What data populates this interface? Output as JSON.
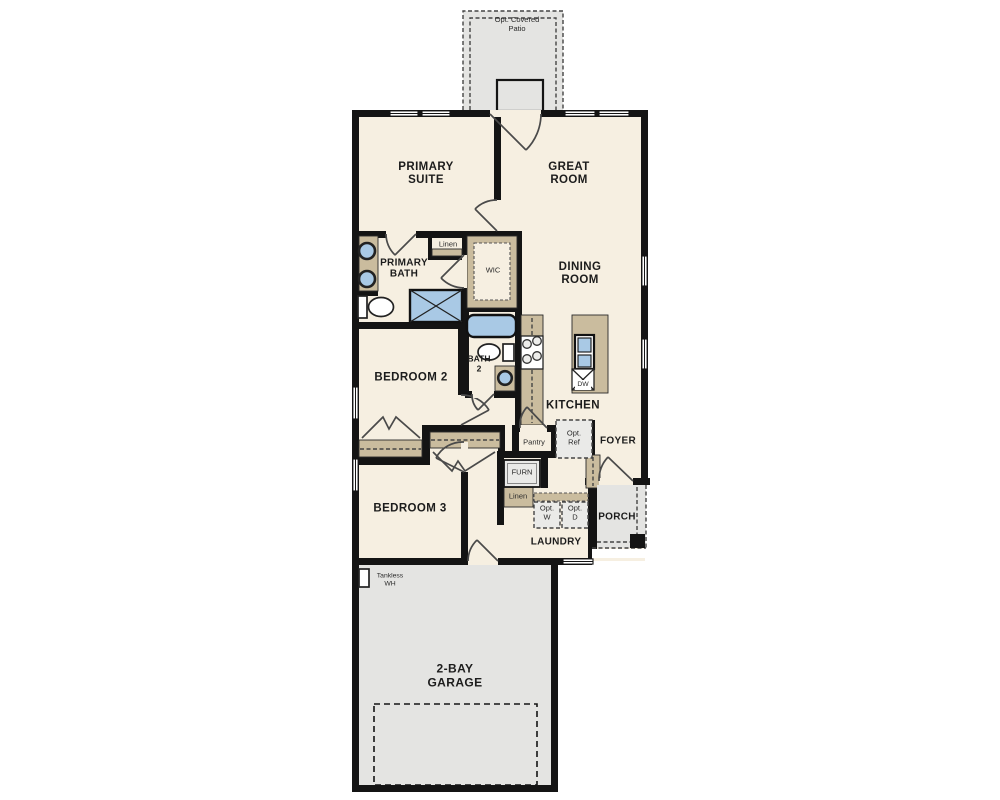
{
  "labels": {
    "patio": "Opt. Covered Patio",
    "primary_suite": "PRIMARY SUITE",
    "great_room": "GREAT ROOM",
    "primary_bath": "PRIMARY BATH",
    "linen_bath": "Linen",
    "wic": "WIC",
    "dining_room": "DINING ROOM",
    "bath2": "BATH 2",
    "bedroom2": "BEDROOM 2",
    "kitchen": "KITCHEN",
    "pantry": "Pantry",
    "opt_ref": "Opt. Ref",
    "foyer": "FOYER",
    "furn": "FURN",
    "linen_hall": "Linen",
    "opt_w": "Opt. W",
    "opt_d": "Opt. D",
    "porch": "PORCH",
    "laundry": "LAUNDRY",
    "bedroom3": "BEDROOM 3",
    "tankless_wh": "Tankless WH",
    "garage": "2-BAY GARAGE",
    "dw": "DW"
  },
  "colors": {
    "wall": "#141414",
    "room": "#f6efe1",
    "tan": "#cabc9e",
    "blue": "#a9c9e5",
    "concrete": "#e4e4e2",
    "line": "#4a4a4a"
  }
}
